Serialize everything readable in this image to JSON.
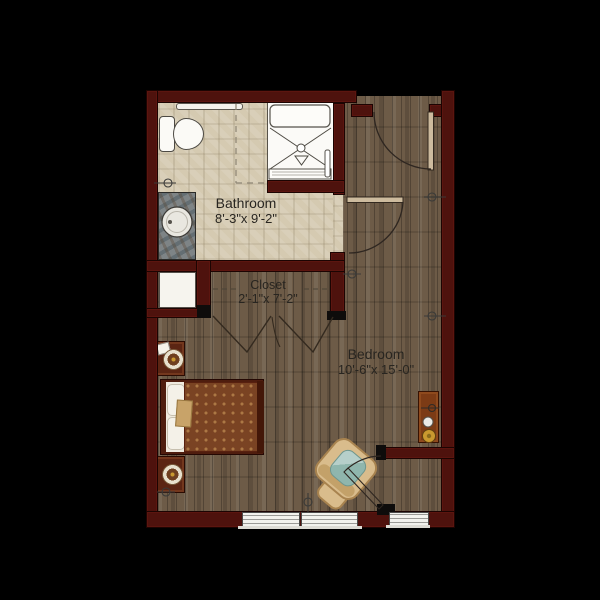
{
  "floorplan": {
    "background": "#000000",
    "rooms": [
      {
        "id": "bathroom",
        "label": "Bathroom",
        "dimensions": "8'-3\"x 9'-2\""
      },
      {
        "id": "closet",
        "label": "Closet",
        "dimensions": "2'-1\"x 7'-2\""
      },
      {
        "id": "bedroom",
        "label": "Bedroom",
        "dimensions": "10'-6\"x 15'-0\""
      }
    ],
    "doors": [
      {
        "id": "entry-door",
        "type": "swing",
        "location": "top wall of bedroom"
      },
      {
        "id": "bathroom-door",
        "type": "swing",
        "location": "wall between bathroom and bedroom"
      },
      {
        "id": "closet-doors",
        "type": "bifold",
        "location": "closet opening"
      },
      {
        "id": "corner-door",
        "type": "swing",
        "location": "bottom-right alcove"
      }
    ],
    "windows": {
      "count": 3,
      "location": "bottom wall"
    },
    "fixtures": [
      "toilet",
      "walk-in-shower-with-seat",
      "shower-drain",
      "shower-grab-bar",
      "vanity-sink",
      "towel-bar",
      "shower-curtain-dashed-line",
      "bed",
      "pillows",
      "nightstand-upper",
      "nightstand-lower",
      "table-lamp-upper",
      "table-lamp-lower",
      "notepad",
      "armchair",
      "ottoman",
      "side-table",
      "electrical-outlet-symbols",
      "linen-cabinet"
    ],
    "palette": {
      "background": "#000000",
      "wall": "#4e120d",
      "wood": "#6d5b47",
      "tile": "#d5cab1",
      "blanket": "#7a4323",
      "chair": "#d9bc8c",
      "cushion": "#8fb6ad",
      "lampgold": "#c9992f",
      "line": "#2e2620"
    }
  }
}
